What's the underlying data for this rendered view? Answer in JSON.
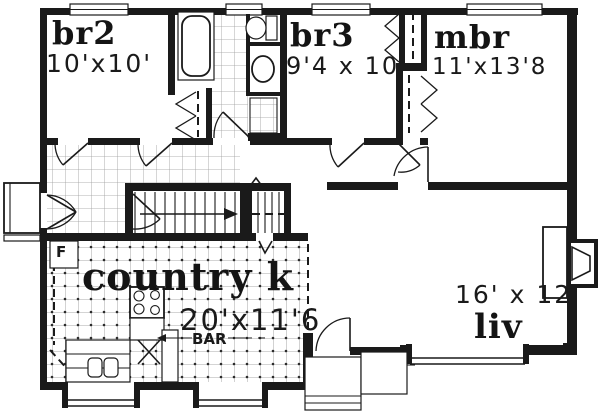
{
  "document": {
    "type": "house floor plan drawing"
  },
  "rooms": {
    "br2": {
      "name": "br2",
      "dims": "10'x10'"
    },
    "br3": {
      "name": "br3",
      "dims": "9'4 x 10'"
    },
    "mbr": {
      "name": "mbr",
      "dims": "11'x13'8"
    },
    "kitchen": {
      "name": "country k",
      "dims": "20'x11'6"
    },
    "living": {
      "name": "liv",
      "dims": "16' x 12'"
    }
  },
  "labels": {
    "bar": "BAR",
    "furnace": "F"
  },
  "colors": {
    "ink": "#1a1a1a",
    "paper": "#ffffff"
  }
}
